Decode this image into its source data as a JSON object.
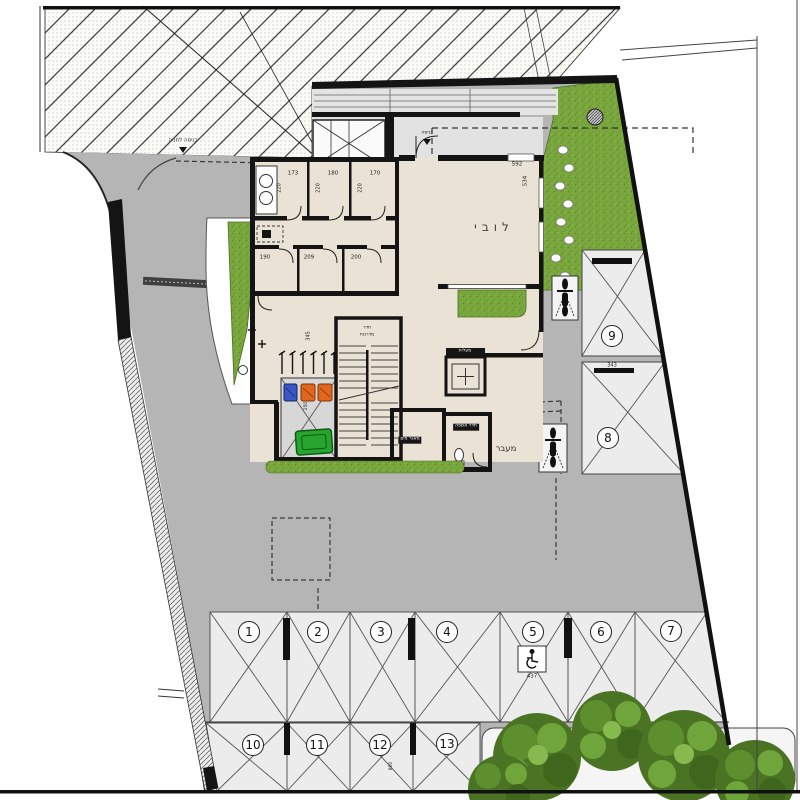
{
  "document": {
    "kind": "architectural ground-floor site plan"
  },
  "labels": {
    "lobby": "לובי",
    "passage": "מעבר",
    "entrance": "כניסה",
    "parking_entrance": "כניסה לחניה",
    "stairwell_line1": "חדר",
    "stairwell_line2": "מדרגות",
    "elevator": "מעלית",
    "water_tank": "מאגר מים",
    "garbage_room": "חדר אשפה"
  },
  "dims": {
    "storage_top": [
      "173",
      "180",
      "170"
    ],
    "storage_depth": "220",
    "storage_bottom": [
      "190",
      "209",
      "200"
    ],
    "lobby_width": "592",
    "lobby_depth": "534",
    "stacker_gap": "343",
    "bike_rack": "345",
    "bin_area": "250",
    "accessible": "437",
    "row2_depth": "800"
  },
  "parking": {
    "nums": [
      "1",
      "2",
      "3",
      "4",
      "5",
      "6",
      "7",
      "8",
      "9",
      "10",
      "11",
      "12",
      "13"
    ]
  },
  "icons": {
    "wheelchair": "wheelchair-icon",
    "motorcycle": "motorcycle-icon",
    "tree": "tree-icon",
    "drain": "drain-icon"
  },
  "colors": {
    "driveway": "#b5b5b5",
    "floor": "#eae2d4",
    "grass": "#7aa63e",
    "wall": "#141414",
    "stall": "#ececec",
    "bin_blue": "#3a57c5",
    "bin_orange": "#e2661c",
    "bin_green": "#27a52f"
  }
}
